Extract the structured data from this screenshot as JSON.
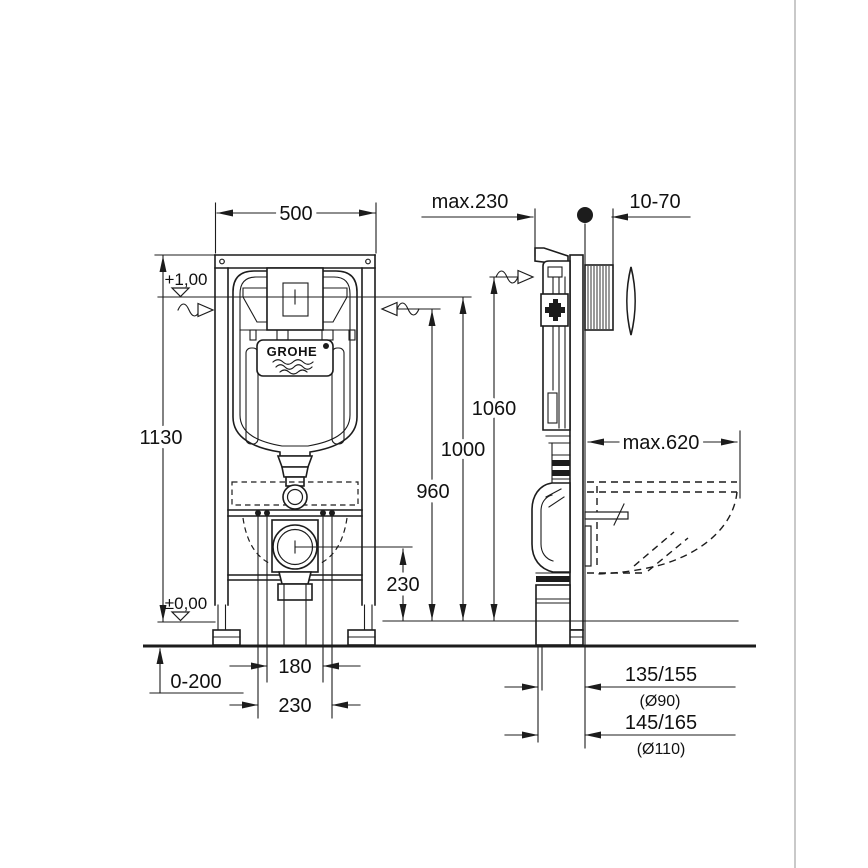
{
  "drawing": {
    "kind": "technical installation drawing",
    "brand": {
      "logo_text": "GROHE"
    },
    "front_view": {
      "width_dim": "500",
      "height_dim": "1130",
      "level_upper": "+1,00",
      "level_floor": "±0,00",
      "floor_adjust_dim": "0-200",
      "bolt_spacing_inner_dim": "180",
      "bolt_spacing_outer_dim": "230",
      "outlet_height_dim": "230"
    },
    "side_view": {
      "frame_depth_dim": "max.230",
      "plate_offset_dim": "10-70",
      "height_1060_dim": "1060",
      "height_1000_dim": "1000",
      "height_960_dim": "960",
      "bowl_depth_dim": "max.620",
      "drain_small_dim": "135/155",
      "drain_small_dia": "(Ø90)",
      "drain_large_dim": "145/165",
      "drain_large_dia": "(Ø110)"
    },
    "line_color": "#1c1c1c",
    "background_color": "#ffffff"
  }
}
